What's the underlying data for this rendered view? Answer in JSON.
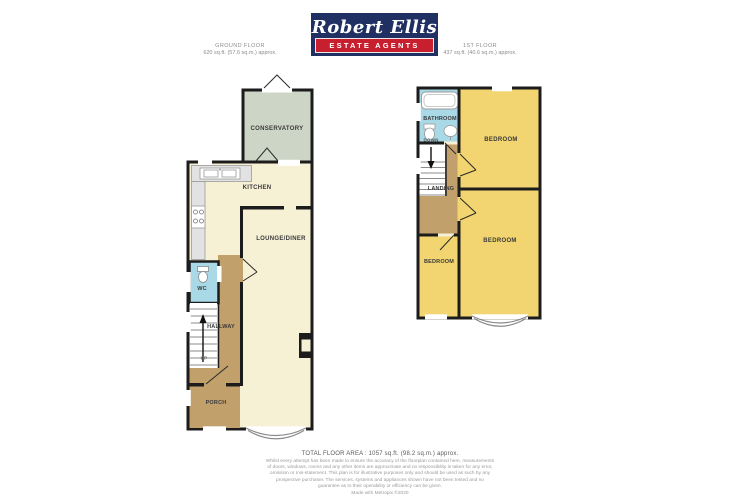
{
  "logo": {
    "brand": "Robert Ellis",
    "tagline": "ESTATE AGENTS",
    "navy": "#203063",
    "red": "#c81f2f"
  },
  "ground_floor": {
    "title": "GROUND FLOOR",
    "area": "620 sq.ft. (57.6 sq.m.) approx.",
    "labels": {
      "conservatory": "CONSERVATORY",
      "kitchen": "KITCHEN",
      "lounge_diner": "LOUNGE/DINER",
      "wc": "WC",
      "hallway": "HALLWAY",
      "porch": "PORCH",
      "stairs_direction": "UP"
    }
  },
  "first_floor": {
    "title": "1ST FLOOR",
    "area": "437 sq.ft. (40.6 sq.m.) approx.",
    "labels": {
      "bathroom": "BATHROOM",
      "landing": "LANDING",
      "bedroom_front": "BEDROOM",
      "bedroom_back": "BEDROOM",
      "bedroom_small": "BEDROOM",
      "stairs_direction": "DOWN"
    }
  },
  "footer": {
    "total_area": "TOTAL FLOOR AREA : 1057 sq.ft. (98.2 sq.m.) approx.",
    "disclaimer": "Whilst every attempt has been made to ensure the accuracy of the floorplan contained here, measurements of doors, windows, rooms and any other items are approximate and no responsibility is taken for any error, omission or mis-statement. This plan is for illustrative purposes only and should be used as such by any prospective purchaser. The services, systems and appliances shown have not been tested and no guarantee as to their operability or efficiency can be given.",
    "credit": "Made with Metropix ©2020"
  },
  "colors": {
    "wall": "#1c1c1c",
    "room_cream": "#f6f0d5",
    "room_yellow": "#f2d470",
    "room_tan": "#c2a06b",
    "room_blue": "#a9d9e6",
    "room_sage": "#cdd5c6",
    "counter_gray": "#e2e2e2"
  }
}
